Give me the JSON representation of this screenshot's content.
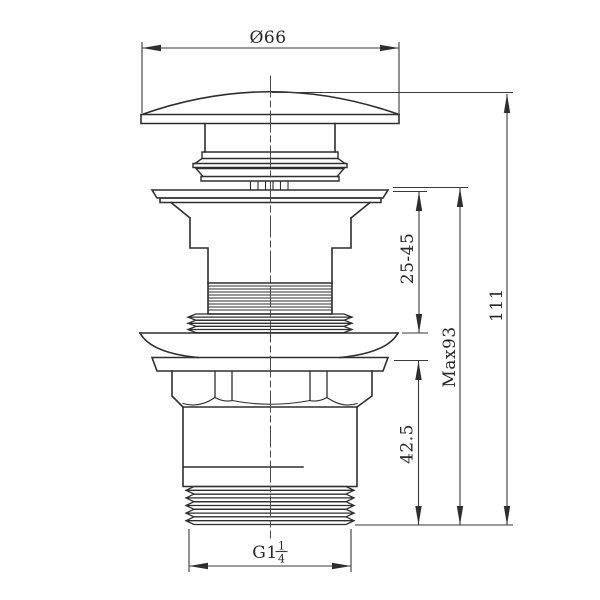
{
  "drawing": {
    "type": "technical-dimension-drawing",
    "subject": "basin pop-up click waste drain, front elevation with dimensions",
    "background_color": "#ffffff",
    "outline_color": "#2e2e2e",
    "dimension_color": "#3a3a3a",
    "dimensions": {
      "cap_diameter": {
        "label": "Ø66",
        "orientation": "horizontal-top"
      },
      "clamp_range": {
        "label": "25-45",
        "orientation": "vertical-right"
      },
      "max_height": {
        "label": "Max93",
        "orientation": "vertical-right"
      },
      "total_height": {
        "label": "111",
        "orientation": "vertical-right"
      },
      "tail_length": {
        "label": "42.5",
        "orientation": "vertical-right"
      },
      "thread": {
        "prefix": "G1",
        "numerator": "1",
        "denominator": "4",
        "orientation": "horizontal-bottom"
      }
    }
  }
}
